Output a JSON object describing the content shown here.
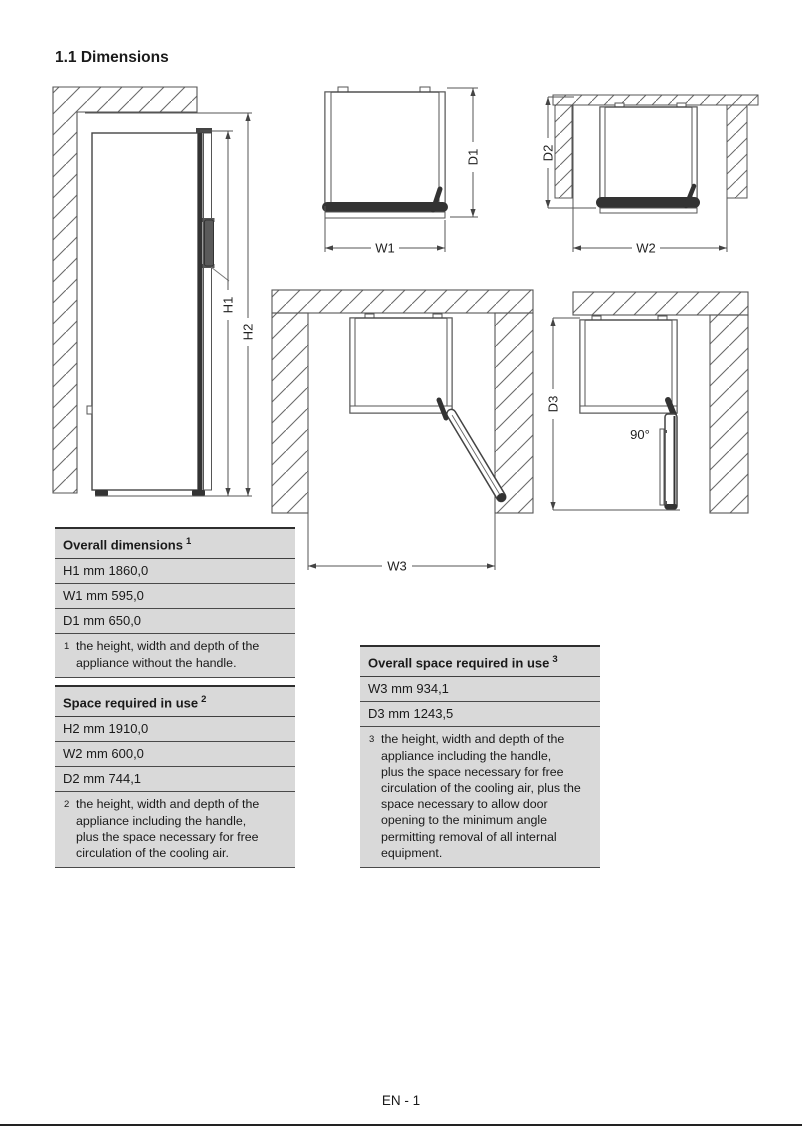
{
  "page": {
    "title": "1.1 Dimensions",
    "footer": "EN - 1"
  },
  "labels": {
    "h1": "H1",
    "h2": "H2",
    "w1": "W1",
    "d1": "D1",
    "w2": "W2",
    "d2": "D2",
    "w3": "W3",
    "d3": "D3",
    "angle": "90°"
  },
  "tables": {
    "overall_dimensions": {
      "title": "Overall dimensions",
      "title_sup": "1",
      "rows": [
        "H1 mm 1860,0",
        "W1 mm 595,0",
        "D1 mm 650,0"
      ],
      "footnote_sup": "1",
      "footnote_lines": [
        "the height, width and depth of the appliance without the handle."
      ]
    },
    "space_required_in_use": {
      "title": "Space required in use",
      "title_sup": "2",
      "rows": [
        "H2 mm 1910,0",
        "W2 mm 600,0",
        "D2 mm 744,1"
      ],
      "footnote_sup": "2",
      "footnote_lines": [
        "the height, width and depth of the appliance including the handle,",
        "plus the space necessary for free circulation of the cooling air."
      ]
    },
    "overall_space_required_in_use": {
      "title": "Overall space required in use",
      "title_sup": "3",
      "rows": [
        "W3 mm 934,1",
        "D3 mm 1243,5"
      ],
      "footnote_sup": "3",
      "footnote_lines": [
        "the height, width and depth of the appliance including the handle,",
        "plus the space necessary for free circulation of the cooling air, plus the space necessary to allow door opening to the minimum angle permitting removal of all internal equipment."
      ]
    }
  },
  "colors": {
    "table_bg": "#d9d9d9",
    "line": "#444444",
    "page_rule": "#222222"
  }
}
